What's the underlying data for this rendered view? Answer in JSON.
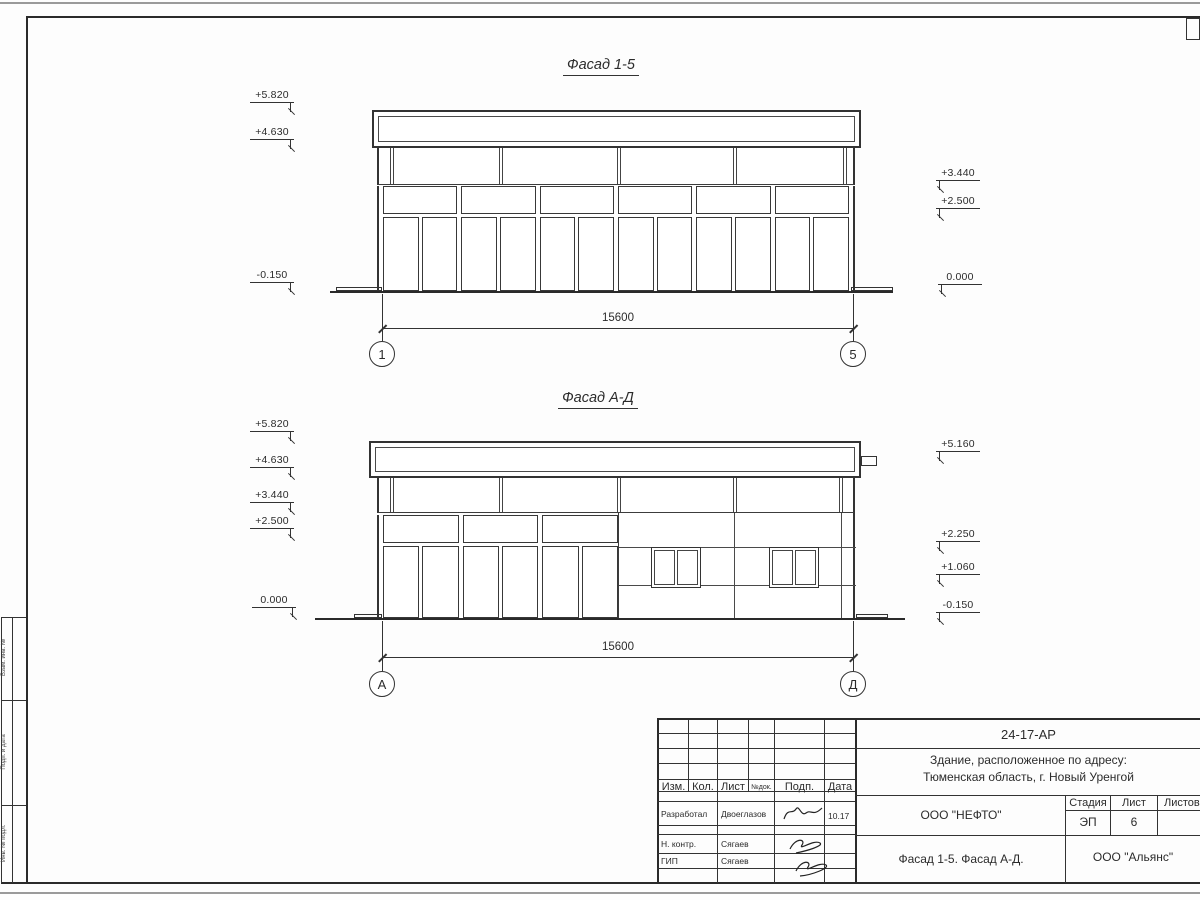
{
  "facade15": {
    "title": "Фасад 1-5",
    "elev_left": [
      "+5.820",
      "+4.630",
      "-0.150"
    ],
    "elev_right": [
      "+3.440",
      "+2.500",
      "0.000"
    ],
    "dim": "15600",
    "axis_left": "1",
    "axis_right": "5"
  },
  "facadeAD": {
    "title": "Фасад А-Д",
    "elev_left": [
      "+5.820",
      "+4.630",
      "+3.440",
      "+2.500",
      "0.000"
    ],
    "elev_right": [
      "+5.160",
      "+2.250",
      "+1.060",
      "-0.150"
    ],
    "dim": "15600",
    "axis_left": "А",
    "axis_right": "Д"
  },
  "frame": {
    "strip_labels": [
      "Взам. инв. №",
      "Подп. и дата",
      "Инв. № подл."
    ]
  },
  "titleblock": {
    "doc_code": "24-17-АР",
    "address_line1": "Здание, расположенное по адресу:",
    "address_line2": "Тюменская область, г. Новый Уренгой",
    "header_cols": [
      "Изм.",
      "Кол.",
      "Лист",
      "№док.",
      "Подп.",
      "Дата"
    ],
    "rows": [
      {
        "role": "Разработал",
        "name": "Двоеглазов",
        "date": "10.17"
      },
      {
        "role": "Н. контр.",
        "name": "Сягаев",
        "date": ""
      },
      {
        "role": "ГИП",
        "name": "Сягаев",
        "date": ""
      }
    ],
    "company": "ООО \"НЕФТО\"",
    "stage_label": "Стадия",
    "sheet_label": "Лист",
    "sheets_label": "Листов",
    "stage": "ЭП",
    "sheet": "6",
    "sheets": "",
    "sheet_title": "Фасад 1-5. Фасад А-Д.",
    "org": "ООО \"Альянс\""
  }
}
